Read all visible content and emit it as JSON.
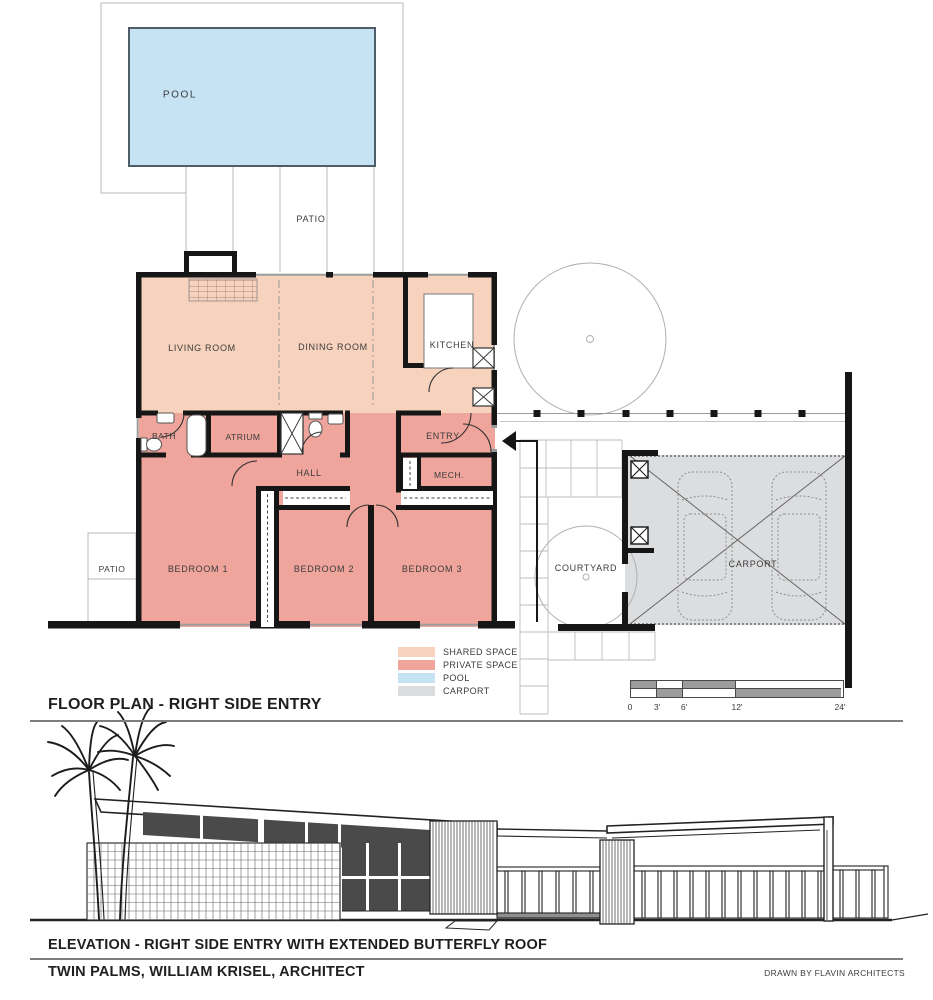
{
  "document": {
    "plan_title": "FLOOR PLAN - RIGHT SIDE ENTRY",
    "elevation_title": "ELEVATION - RIGHT SIDE ENTRY WITH EXTENDED BUTTERFLY ROOF",
    "project_title": "TWIN PALMS, WILLIAM KRISEL, ARCHITECT",
    "credit": "DRAWN BY FLAVIN ARCHITECTS"
  },
  "plan": {
    "rooms": {
      "pool": "POOL",
      "patio_top": "PATIO",
      "living": "LIVING ROOM",
      "dining": "DINING ROOM",
      "kitchen": "KITCHEN",
      "bath": "BATH",
      "atrium": "ATRIUM",
      "hall": "HALL",
      "entry": "ENTRY",
      "mech": "MECH.",
      "bedroom1": "BEDROOM 1",
      "bedroom2": "BEDROOM 2",
      "bedroom3": "BEDROOM 3",
      "patio_left": "PATIO",
      "courtyard": "COURTYARD",
      "carport": "CARPORT"
    }
  },
  "legend": {
    "items": [
      {
        "label": "SHARED SPACE",
        "color": "#f7d2bc"
      },
      {
        "label": "PRIVATE SPACE",
        "color": "#efa49c"
      },
      {
        "label": "POOL",
        "color": "#c5e3f3"
      },
      {
        "label": "CARPORT",
        "color": "#dcdddf"
      }
    ]
  },
  "scale_bar": {
    "ticks": [
      "0",
      "3'",
      "6'",
      "12'",
      "24'"
    ]
  },
  "colors": {
    "shared_space": "#f7d2bc",
    "private_space": "#efa49c",
    "pool": "#c5e3f3",
    "carport": "#dcdddf",
    "wall": "#161616"
  }
}
